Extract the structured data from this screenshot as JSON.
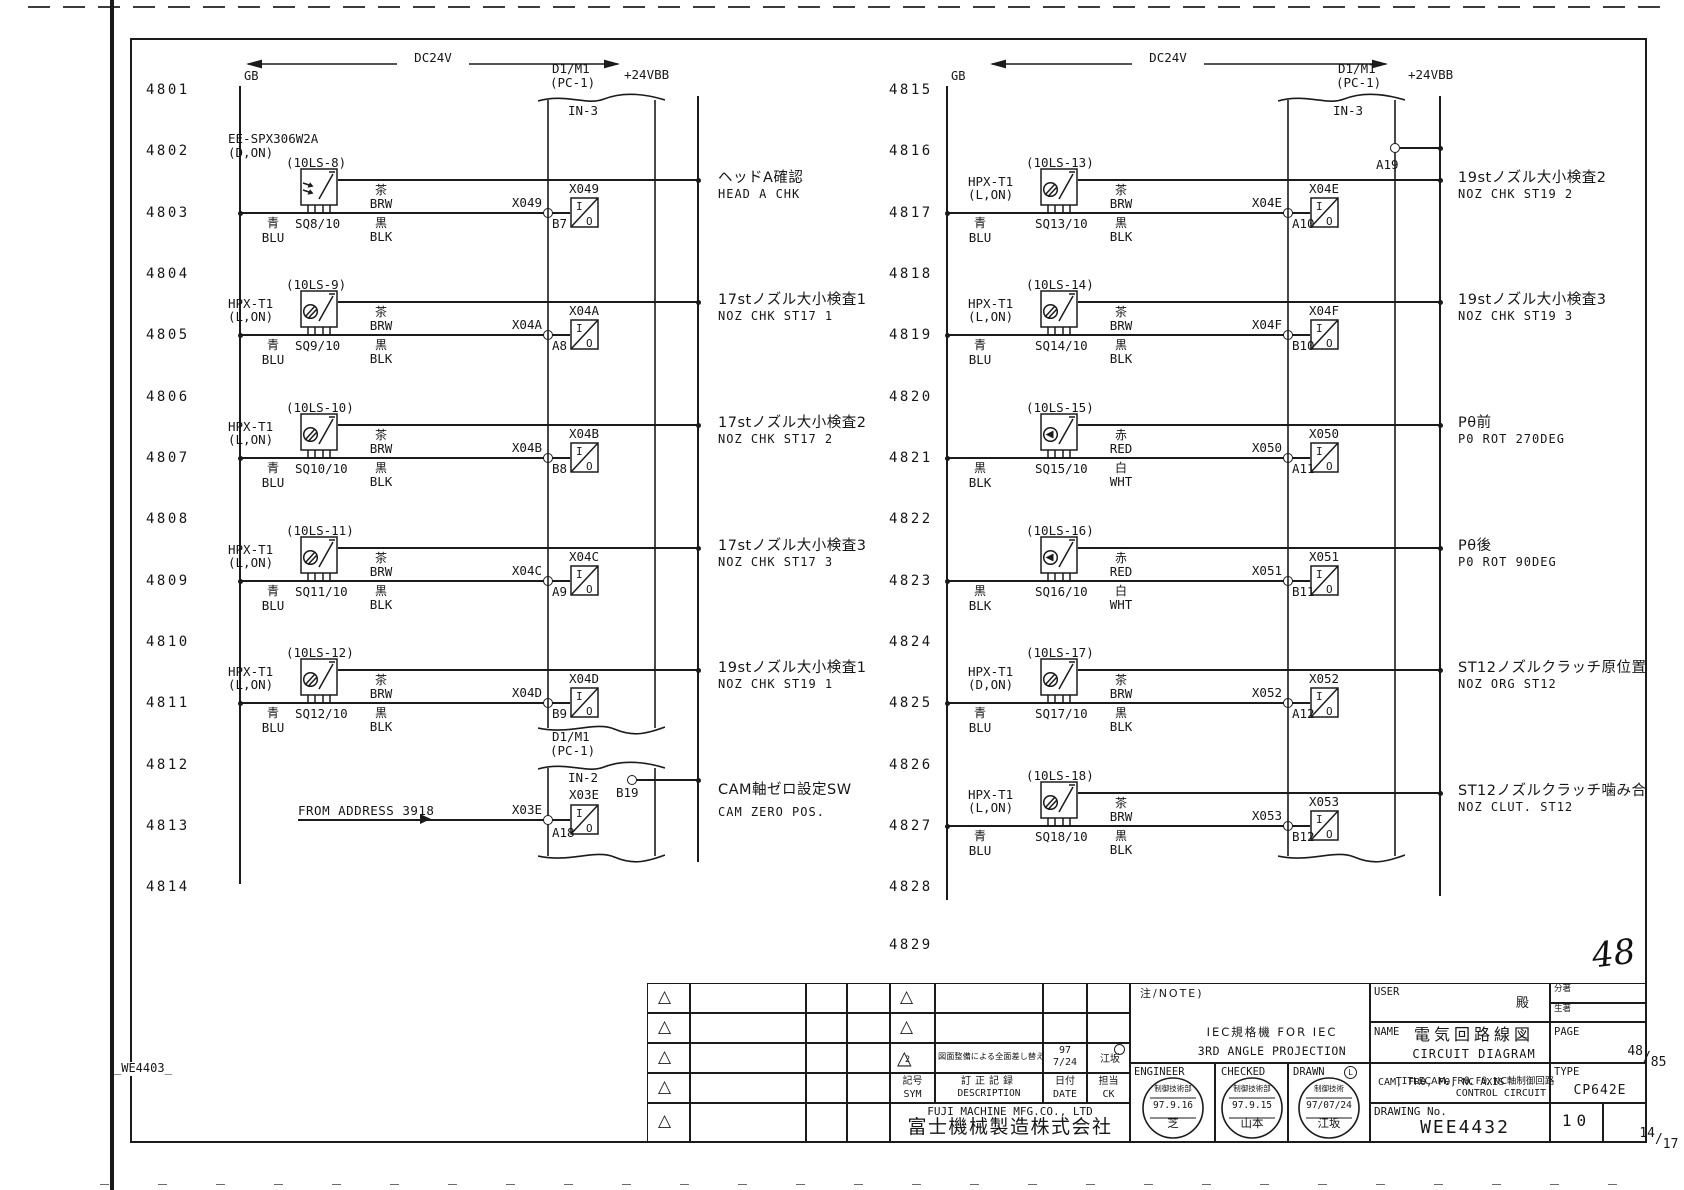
{
  "meta": {
    "sheet_code": "_WE4403_",
    "handwritten_no": "48"
  },
  "supply": {
    "dc_label": "DC24V",
    "rail_label": "+24VBB",
    "bus_label": "GB"
  },
  "connectors": {
    "left_in3": {
      "title": "D1/M1",
      "sub": "(PC-1)",
      "port": "IN-3"
    },
    "left_in2": {
      "title": "D1/M1",
      "sub": "(PC-1)",
      "port": "IN-2",
      "pin": "B19"
    },
    "right_in3": {
      "title": "D1/M1",
      "sub": "(PC-1)",
      "port": "IN-3",
      "pin": "A19"
    }
  },
  "rows_left": [
    "4801",
    "4802",
    "4803",
    "4804",
    "4805",
    "4806",
    "4807",
    "4808",
    "4809",
    "4810",
    "4811",
    "4812",
    "4813",
    "4814"
  ],
  "rows_right": [
    "4815",
    "4816",
    "4817",
    "4818",
    "4819",
    "4820",
    "4821",
    "4822",
    "4823",
    "4824",
    "4825",
    "4826",
    "4827",
    "4828",
    "4829"
  ],
  "circuits_left": [
    {
      "row_i": 2,
      "ls": "(10LS-8)",
      "model": "EE-SPX306W2A",
      "mode": "(D,ON)",
      "high": true,
      "glyph": "arrows",
      "sq": "SQ8/10",
      "w_left": [
        "青",
        "BLU"
      ],
      "w_top": [
        "茶",
        "BRW"
      ],
      "w_bot": [
        "黒",
        "BLK"
      ],
      "signal": "X049",
      "pin": "B7",
      "io": "X049",
      "desc_jp": "ヘッドA確認",
      "desc_en": "HEAD A CHK"
    },
    {
      "row_i": 4,
      "ls": "(10LS-9)",
      "model": "HPX-T1",
      "mode": "(L,ON)",
      "glyph": "circle",
      "sq": "SQ9/10",
      "w_left": [
        "青",
        "BLU"
      ],
      "w_top": [
        "茶",
        "BRW"
      ],
      "w_bot": [
        "黒",
        "BLK"
      ],
      "signal": "X04A",
      "pin": "A8",
      "io": "X04A",
      "desc_jp": "17stノズル大小検査1",
      "desc_en": "NOZ CHK ST17 1"
    },
    {
      "row_i": 6,
      "ls": "(10LS-10)",
      "model": "HPX-T1",
      "mode": "(L,ON)",
      "glyph": "circle",
      "sq": "SQ10/10",
      "w_left": [
        "青",
        "BLU"
      ],
      "w_top": [
        "茶",
        "BRW"
      ],
      "w_bot": [
        "黒",
        "BLK"
      ],
      "signal": "X04B",
      "pin": "B8",
      "io": "X04B",
      "desc_jp": "17stノズル大小検査2",
      "desc_en": "NOZ CHK ST17 2"
    },
    {
      "row_i": 8,
      "ls": "(10LS-11)",
      "model": "HPX-T1",
      "mode": "(L,ON)",
      "glyph": "circle",
      "sq": "SQ11/10",
      "w_left": [
        "青",
        "BLU"
      ],
      "w_top": [
        "茶",
        "BRW"
      ],
      "w_bot": [
        "黒",
        "BLK"
      ],
      "signal": "X04C",
      "pin": "A9",
      "io": "X04C",
      "desc_jp": "17stノズル大小検査3",
      "desc_en": "NOZ CHK ST17 3"
    },
    {
      "row_i": 10,
      "ls": "(10LS-12)",
      "model": "HPX-T1",
      "mode": "(L,ON)",
      "glyph": "circle",
      "sq": "SQ12/10",
      "w_left": [
        "青",
        "BLU"
      ],
      "w_top": [
        "茶",
        "BRW"
      ],
      "w_bot": [
        "黒",
        "BLK"
      ],
      "signal": "X04D",
      "pin": "B9",
      "io": "X04D",
      "desc_jp": "19stノズル大小検査1",
      "desc_en": "NOZ CHK ST19 1"
    }
  ],
  "special_left": {
    "from_label": "FROM ADDRESS 3918",
    "signal": "X03E",
    "pin": "A18",
    "io": "X03E",
    "desc_jp": "CAM軸ゼロ設定SW",
    "desc_en": "CAM ZERO POS."
  },
  "circuits_right": [
    {
      "row_i": 2,
      "ls": "(10LS-13)",
      "model": "HPX-T1",
      "mode": "(L,ON)",
      "glyph": "circle",
      "sq": "SQ13/10",
      "w_left": [
        "青",
        "BLU"
      ],
      "w_top": [
        "茶",
        "BRW"
      ],
      "w_bot": [
        "黒",
        "BLK"
      ],
      "signal": "X04E",
      "pin": "A10",
      "io": "X04E",
      "desc_jp": "19stノズル大小検査2",
      "desc_en": "NOZ CHK ST19 2"
    },
    {
      "row_i": 4,
      "ls": "(10LS-14)",
      "model": "HPX-T1",
      "mode": "(L,ON)",
      "glyph": "circle",
      "sq": "SQ14/10",
      "w_left": [
        "青",
        "BLU"
      ],
      "w_top": [
        "茶",
        "BRW"
      ],
      "w_bot": [
        "黒",
        "BLK"
      ],
      "signal": "X04F",
      "pin": "B10",
      "io": "X04F",
      "desc_jp": "19stノズル大小検査3",
      "desc_en": "NOZ CHK ST19 3"
    },
    {
      "row_i": 6,
      "ls": "(10LS-15)",
      "glyph": "diamond",
      "sq": "SQ15/10",
      "w_left": [
        "黒",
        "BLK"
      ],
      "w_top": [
        "赤",
        "RED"
      ],
      "w_bot": [
        "白",
        "WHT"
      ],
      "signal": "X050",
      "pin": "A11",
      "io": "X050",
      "desc_jp": "Pθ前",
      "desc_en": "P0 ROT 270DEG"
    },
    {
      "row_i": 8,
      "ls": "(10LS-16)",
      "glyph": "diamond",
      "sq": "SQ16/10",
      "w_left": [
        "黒",
        "BLK"
      ],
      "w_top": [
        "赤",
        "RED"
      ],
      "w_bot": [
        "白",
        "WHT"
      ],
      "signal": "X051",
      "pin": "B11",
      "io": "X051",
      "desc_jp": "Pθ後",
      "desc_en": "P0 ROT 90DEG"
    },
    {
      "row_i": 10,
      "ls": "(10LS-17)",
      "model": "HPX-T1",
      "mode": "(D,ON)",
      "glyph": "circle",
      "sq": "SQ17/10",
      "w_left": [
        "青",
        "BLU"
      ],
      "w_top": [
        "茶",
        "BRW"
      ],
      "w_bot": [
        "黒",
        "BLK"
      ],
      "signal": "X052",
      "pin": "A12",
      "io": "X052",
      "desc_jp": "ST12ノズルクラッチ原位置",
      "desc_en": "NOZ ORG ST12"
    },
    {
      "row_i": 12,
      "ls": "(10LS-18)",
      "model": "HPX-T1",
      "mode": "(L,ON)",
      "glyph": "circle",
      "sq": "SQ18/10",
      "w_left": [
        "青",
        "BLU"
      ],
      "w_top": [
        "茶",
        "BRW"
      ],
      "w_bot": [
        "黒",
        "BLK"
      ],
      "signal": "X053",
      "pin": "B12",
      "io": "X053",
      "desc_jp": "ST12ノズルクラッチ噛み合",
      "desc_en": "NOZ CLUT. ST12"
    }
  ],
  "titleblock": {
    "note": {
      "label": "注/NOTE)",
      "iec1": "IEC規格機 FOR IEC",
      "iec2": "3RD ANGLE PROJECTION"
    },
    "user": {
      "label": "USER",
      "suffix": "殿",
      "class1": "分著",
      "class2": "生著"
    },
    "name": {
      "label": "NAME",
      "jp": "電気回路線図",
      "en": "CIRCUIT DIAGRAM"
    },
    "page": {
      "label": "PAGE",
      "no": "48",
      "of": "85"
    },
    "title": {
      "label": "TITLE",
      "jp": "CAM, FRθ, Fθ, NC軸制御回路",
      "en1": "CAM, FRθ, Fθ, NC AXIS",
      "en2": "CONTROL CIRCUIT"
    },
    "type": {
      "label": "TYPE",
      "value": "CP642E"
    },
    "drawing": {
      "label": "DRAWING No.",
      "no": "WEE4432",
      "sheet": "10",
      "frac_top": "14",
      "frac_bot": "17"
    },
    "sign": {
      "engineer": "ENGINEER",
      "checked": "CHECKED",
      "drawn": "DRAWN",
      "drawn_mark": "L"
    },
    "stamps": [
      {
        "dept": "制御技術部",
        "date": "97.9.16",
        "name": "芝"
      },
      {
        "dept": "制御技術部",
        "date": "97.9.15",
        "name": "山本"
      },
      {
        "dept": "制御技術",
        "date": "97/07/24",
        "name": "江坂"
      }
    ],
    "revision": {
      "sym_jp": "記号",
      "sym_en": "SYM",
      "desc_jp": "訂正記録",
      "desc_en": "DESCRIPTION",
      "date_jp": "日付",
      "date_en": "DATE",
      "ck_jp": "担当",
      "ck_en": "CK",
      "rev2_sym": "2",
      "rev2_desc": "図面整備による全面差し替え",
      "rev2_year": "97",
      "rev2_date": "7/24",
      "rev2_ck": "江坂"
    },
    "company": {
      "en": "FUJI MACHINE MFG.CO., LTD",
      "jp": "富士機械製造株式会社"
    }
  }
}
